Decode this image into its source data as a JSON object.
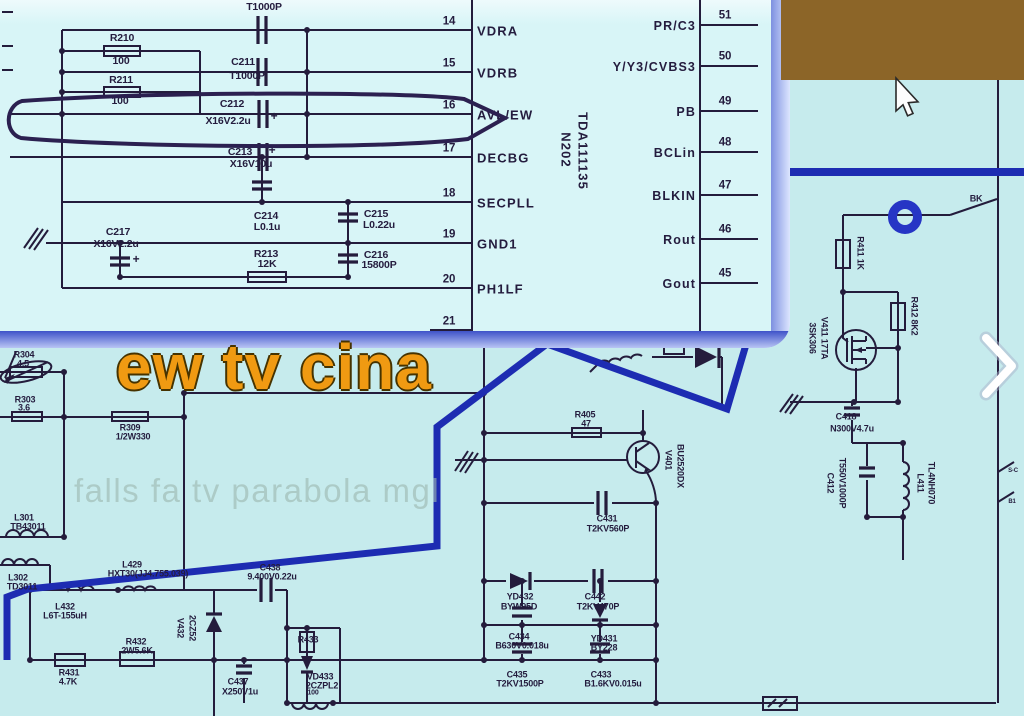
{
  "colors": {
    "bg": "#c6ebed",
    "inset-bg": "#d8f5f7",
    "inset-top": "#eefafc",
    "line": "#241c3c",
    "hl": "#1d2cb2",
    "ring": "#2635c5",
    "brown": "#8c6528",
    "orange": "#f09a12",
    "orange-stroke": "#463300",
    "watermark": "#9db8b0",
    "label": "#241c3e",
    "band-dark": "#3f53c9",
    "band-light": "#b9c5f4"
  },
  "overlay": {
    "title": "ew tv cina",
    "watermark": "falls fa tv parabola mgl"
  },
  "inset": {
    "ic": {
      "ref": "N202",
      "part": "TDA111135"
    },
    "left_pins": [
      {
        "num": "14",
        "label": "VDRA",
        "y": 30
      },
      {
        "num": "15",
        "label": "VDRB",
        "y": 72
      },
      {
        "num": "16",
        "label": "AVL/EW",
        "y": 114
      },
      {
        "num": "17",
        "label": "DECBG",
        "y": 157
      },
      {
        "num": "18",
        "label": "SECPLL",
        "y": 202
      },
      {
        "num": "19",
        "label": "GND1",
        "y": 243
      },
      {
        "num": "20",
        "label": "PH1LF",
        "y": 288
      },
      {
        "num": "21",
        "label": "",
        "y": 330
      }
    ],
    "right_pins": [
      {
        "label": "PR/C3",
        "num": "51",
        "y": 25
      },
      {
        "label": "Y/Y3/CVBS3",
        "num": "50",
        "y": 66
      },
      {
        "label": "PB",
        "num": "49",
        "y": 111
      },
      {
        "label": "BCLin",
        "num": "48",
        "y": 152
      },
      {
        "label": "BLKIN",
        "num": "47",
        "y": 195
      },
      {
        "label": "Rout",
        "num": "46",
        "y": 239
      },
      {
        "label": "Gout",
        "num": "45",
        "y": 283
      }
    ],
    "labels": [
      {
        "t": "T1000P",
        "x": 264,
        "y": 7
      },
      {
        "t": "R210",
        "x": 122,
        "y": 38
      },
      {
        "t": "100",
        "x": 121,
        "y": 61
      },
      {
        "t": "C211",
        "x": 243,
        "y": 62
      },
      {
        "t": "T1000P",
        "x": 247,
        "y": 76
      },
      {
        "t": "R211",
        "x": 121,
        "y": 80
      },
      {
        "t": "100",
        "x": 120,
        "y": 101
      },
      {
        "t": "C212",
        "x": 232,
        "y": 104
      },
      {
        "t": "X16V2.2u",
        "x": 228,
        "y": 121
      },
      {
        "t": "+",
        "x": 274,
        "y": 116,
        "s": 12
      },
      {
        "t": "C213",
        "x": 240,
        "y": 152
      },
      {
        "t": "+",
        "x": 272,
        "y": 150,
        "s": 12
      },
      {
        "t": "X16V10u",
        "x": 251,
        "y": 164
      },
      {
        "t": "C214",
        "x": 266,
        "y": 216
      },
      {
        "t": "L0.1u",
        "x": 267,
        "y": 227
      },
      {
        "t": "C215",
        "x": 376,
        "y": 214
      },
      {
        "t": "L0.22u",
        "x": 379,
        "y": 225
      },
      {
        "t": "C216",
        "x": 376,
        "y": 255
      },
      {
        "t": "15800P",
        "x": 379,
        "y": 265
      },
      {
        "t": "C217",
        "x": 118,
        "y": 232
      },
      {
        "t": "X16V2.2u",
        "x": 116,
        "y": 244
      },
      {
        "t": "+",
        "x": 136,
        "y": 259,
        "s": 12
      },
      {
        "t": "R213",
        "x": 266,
        "y": 254
      },
      {
        "t": "12K",
        "x": 267,
        "y": 264
      }
    ]
  },
  "main": {
    "labels": [
      {
        "t": "R304",
        "x": 24,
        "y": 355
      },
      {
        "t": "4.5",
        "x": 23,
        "y": 364
      },
      {
        "t": "R303",
        "x": 25,
        "y": 400
      },
      {
        "t": "3.6",
        "x": 24,
        "y": 408
      },
      {
        "t": "R309",
        "x": 130,
        "y": 428
      },
      {
        "t": "1/2W330",
        "x": 133,
        "y": 437
      },
      {
        "t": "L301",
        "x": 24,
        "y": 518
      },
      {
        "t": "TB43011",
        "x": 28,
        "y": 527
      },
      {
        "t": "L302",
        "x": 18,
        "y": 578
      },
      {
        "t": "TD3011",
        "x": 22,
        "y": 587
      },
      {
        "t": "L429",
        "x": 132,
        "y": 565
      },
      {
        "t": "HXT30(JJ4.755.039)",
        "x": 148,
        "y": 574
      },
      {
        "t": "C438",
        "x": 270,
        "y": 568
      },
      {
        "t": "9.400V0.22u",
        "x": 272,
        "y": 577
      },
      {
        "t": "L432",
        "x": 65,
        "y": 607
      },
      {
        "t": "L6T-155uH",
        "x": 65,
        "y": 616
      },
      {
        "t": "R432",
        "x": 136,
        "y": 642
      },
      {
        "t": "2W5.6K",
        "x": 137,
        "y": 651
      },
      {
        "t": "R431",
        "x": 69,
        "y": 673
      },
      {
        "t": "4.7K",
        "x": 68,
        "y": 682
      },
      {
        "t": "V432",
        "x": 180,
        "y": 628,
        "r": 90
      },
      {
        "t": "2CZ52",
        "x": 192,
        "y": 628,
        "r": 90
      },
      {
        "t": "C437",
        "x": 238,
        "y": 682
      },
      {
        "t": "X250V1u",
        "x": 240,
        "y": 692
      },
      {
        "t": "R433",
        "x": 308,
        "y": 640
      },
      {
        "t": "VD433",
        "x": 320,
        "y": 677
      },
      {
        "t": "2CZPL2",
        "x": 322,
        "y": 686
      },
      {
        "t": "100",
        "x": 313,
        "y": 693,
        "s": 7
      },
      {
        "t": "C431",
        "x": 607,
        "y": 519
      },
      {
        "t": "T2KV560P",
        "x": 608,
        "y": 529
      },
      {
        "t": "YD432",
        "x": 520,
        "y": 597
      },
      {
        "t": "BYW95D",
        "x": 519,
        "y": 607
      },
      {
        "t": "C442",
        "x": 595,
        "y": 597
      },
      {
        "t": "T2KV470P",
        "x": 598,
        "y": 607
      },
      {
        "t": "C434",
        "x": 519,
        "y": 637
      },
      {
        "t": "B630V0.018u",
        "x": 522,
        "y": 646
      },
      {
        "t": "YD431",
        "x": 604,
        "y": 639
      },
      {
        "t": "BY228",
        "x": 604,
        "y": 648
      },
      {
        "t": "C435",
        "x": 517,
        "y": 675
      },
      {
        "t": "T2KV1500P",
        "x": 520,
        "y": 684
      },
      {
        "t": "C433",
        "x": 601,
        "y": 675
      },
      {
        "t": "B1.6KV0.015u",
        "x": 613,
        "y": 684
      },
      {
        "t": "R405",
        "x": 585,
        "y": 415
      },
      {
        "t": "47",
        "x": 586,
        "y": 424
      },
      {
        "t": "V401",
        "x": 668,
        "y": 460,
        "r": 90
      },
      {
        "t": "BU2520DX",
        "x": 680,
        "y": 466,
        "r": 90
      },
      {
        "t": "BK",
        "x": 976,
        "y": 199
      },
      {
        "t": "R411 1K",
        "x": 860,
        "y": 253,
        "r": 90
      },
      {
        "t": "R412 8K2",
        "x": 914,
        "y": 316,
        "r": 90
      },
      {
        "t": "3SK306",
        "x": 812,
        "y": 338,
        "r": 90
      },
      {
        "t": "V411 17TA",
        "x": 824,
        "y": 338,
        "r": 90
      },
      {
        "t": "C418",
        "x": 846,
        "y": 417
      },
      {
        "t": "N300V4.7u",
        "x": 852,
        "y": 429
      },
      {
        "t": "C412",
        "x": 830,
        "y": 483,
        "r": 90
      },
      {
        "t": "T550V1000P",
        "x": 842,
        "y": 483,
        "r": 90
      },
      {
        "t": "L411",
        "x": 920,
        "y": 483,
        "r": 90
      },
      {
        "t": "TL4NH070",
        "x": 931,
        "y": 483,
        "r": 90
      },
      {
        "t": "S-C",
        "x": 1013,
        "y": 471,
        "s": 6
      },
      {
        "t": "B1",
        "x": 1012,
        "y": 502,
        "s": 6
      }
    ]
  }
}
